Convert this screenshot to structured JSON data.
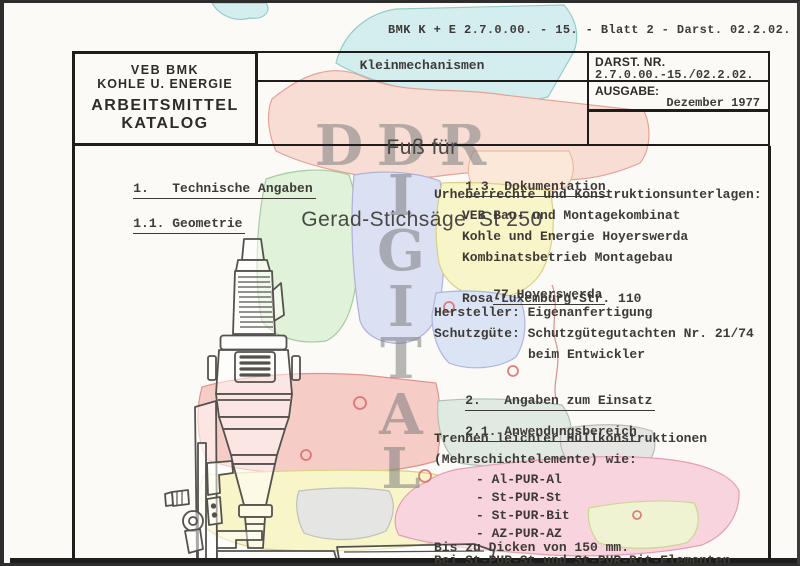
{
  "page": {
    "ref_line": "BMK K + E 2.7.0.00. - 15. - Blatt 2 - Darst. 02.2.02."
  },
  "header": {
    "org": {
      "line1": "VEB BMK",
      "line2": "KOHLE U. ENERGIE",
      "line3": "ARBEITSMITTEL",
      "line4": "KATALOG"
    },
    "category": "Kleinmechanismen",
    "title": {
      "line1": "Fuß für",
      "line2": "Gerad-Stichsäge  St 250"
    },
    "darst": {
      "label": "DARST. NR.",
      "value": "2.7.0.00.-15./02.2.02."
    },
    "ausgabe": {
      "label": "AUSGABE:",
      "value": "Dezember 1977"
    }
  },
  "left_column": {
    "heading1": "1.   Technische Angaben",
    "heading2": "1.1. Geometrie"
  },
  "right_column": {
    "heading13": "1.3. Dokumentation",
    "doc_intro": "Urheberrechte und Konstruktionsunterlagen:",
    "doc_org": [
      "VEB Bau- und Montagekombinat",
      "Kohle und Energie Hoyerswerda",
      "Kombinatsbetrieb Montagebau"
    ],
    "address": [
      "77 Hoyerswerda",
      "Rosa-Luxemburg-Str. 110"
    ],
    "hersteller": "Hersteller: Eigenanfertigung",
    "schutzguete_line1": "Schutzgüte: Schutzgütegutachten Nr. 21/74",
    "schutzguete_line2": "beim Entwickler",
    "heading2": "2.   Angaben zum Einsatz",
    "heading21": "2.1. Anwendungsbereich",
    "usage_line1": "Trennen leichter Hüllkonstruktionen",
    "usage_line2": "(Mehrschichtelemente) wie:",
    "materials": [
      "- Al-PUR-Al",
      "- St-PUR-St",
      "- St-PUR-Bit",
      "- AZ-PUR-AZ"
    ],
    "thickness_note": "Bis zu Dicken von 150 mm.",
    "element_note": "Bei St-PUR-St und St-PUR-Bit-Elementen"
  },
  "watermark": {
    "row_letters": [
      "D",
      "D",
      "R"
    ],
    "column_letters": [
      "I",
      "G",
      "I",
      "T",
      "A",
      "L"
    ]
  },
  "illustration": {
    "label": "Gerad-Stichsäge St 250 Zeichnung"
  },
  "colors": {
    "ink": "#3e3a35",
    "border": "#1f1d1b",
    "watermark_gray": "#8f8f8f",
    "map_cyan": "#d2eef0",
    "map_salmon": "#f8dcd3",
    "map_peach": "#fbe8d7",
    "map_green": "#dff2d8",
    "map_lavender": "#dbdff3",
    "map_yellow": "#f8f5c6",
    "map_blue": "#dae3f5",
    "map_red_pink": "#f6cac5",
    "map_graygreen": "#dfe9e1",
    "map_gray": "#e4e4e2",
    "map_pink": "#f8d3dd",
    "map_palegreen": "#eff3cf",
    "map_border_red": "#dd8a84"
  }
}
